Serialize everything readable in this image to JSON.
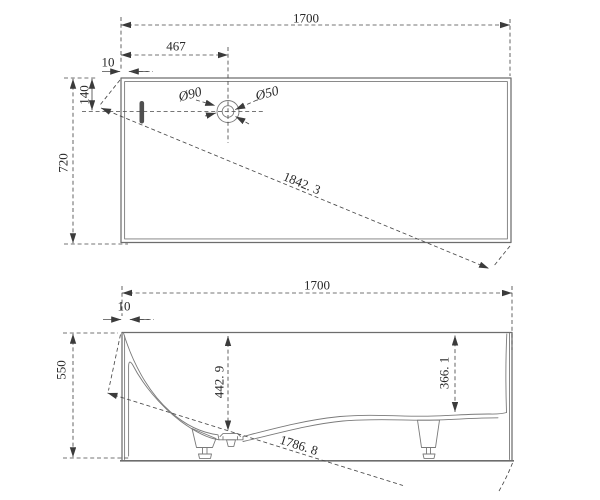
{
  "drawing": {
    "kind": "bathtub technical drawing, two orthographic views",
    "palette": {
      "background": "#ffffff",
      "outline_color": "#6d6d6d",
      "dimension_color": "#4a4a4a",
      "text_color": "#282828",
      "slot_fill": "#4f4f4f"
    },
    "top_view": {
      "dims": {
        "overall_width": "1700",
        "overall_depth": "720",
        "drain_offset_x": "467",
        "rim_thickness": "10",
        "drain_offset_y": "140",
        "diagonal": "1842. 3",
        "drain_outer_dia": "Ø90",
        "drain_inner_dia": "Ø50"
      }
    },
    "side_view": {
      "dims": {
        "overall_width": "1700",
        "overall_height": "550",
        "rim_thickness": "10",
        "depth_at_drain": "442. 9",
        "depth_at_right": "366. 1",
        "diagonal": "1786. 8"
      }
    }
  }
}
